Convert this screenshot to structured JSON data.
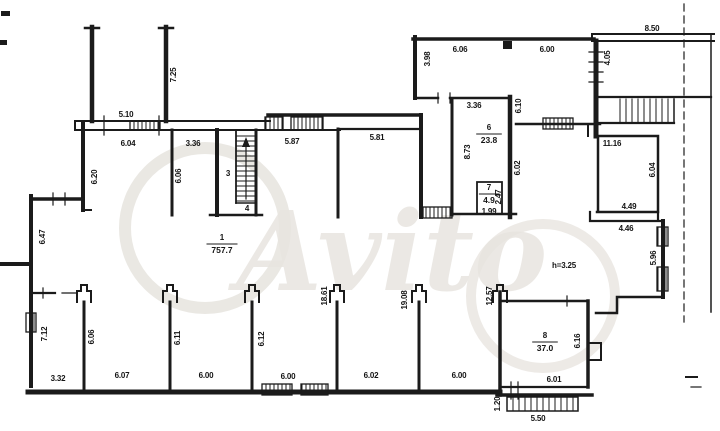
{
  "page": {
    "background": "#ffffff"
  },
  "watermark": {
    "text": "Avito",
    "color": "#e8e5e0"
  },
  "plan": {
    "ink": "#1b1b1b",
    "height_note": "h=3.25",
    "rooms": [
      {
        "num": "1",
        "area": "757.7",
        "x": 222,
        "y": 243
      },
      {
        "num": "6",
        "area": "23.8",
        "x": 489,
        "y": 133
      },
      {
        "num": "7",
        "area": "4.9",
        "x": 489,
        "y": 193
      },
      {
        "num": "8",
        "area": "37.0",
        "x": 545,
        "y": 341
      }
    ],
    "labels": [
      {
        "text": "5.10",
        "x": 126,
        "y": 117
      },
      {
        "text": "6.04",
        "x": 128,
        "y": 146
      },
      {
        "text": "3.36",
        "x": 193,
        "y": 146
      },
      {
        "text": "5.87",
        "x": 292,
        "y": 144
      },
      {
        "text": "5.81",
        "x": 377,
        "y": 140
      },
      {
        "text": "7.25",
        "x": 176,
        "y": 75,
        "rot": -90
      },
      {
        "text": "6.20",
        "x": 97,
        "y": 177,
        "rot": -90
      },
      {
        "text": "6.06",
        "x": 181,
        "y": 176,
        "rot": -90
      },
      {
        "text": "3",
        "x": 228,
        "y": 176
      },
      {
        "text": "4",
        "x": 247,
        "y": 211
      },
      {
        "text": "6.47",
        "x": 45,
        "y": 237,
        "rot": -90
      },
      {
        "text": "6.06",
        "x": 460,
        "y": 52
      },
      {
        "text": "6.00",
        "x": 547,
        "y": 52
      },
      {
        "text": "8.50",
        "x": 652,
        "y": 31
      },
      {
        "text": "3.98",
        "x": 430,
        "y": 59,
        "rot": -90
      },
      {
        "text": "4.05",
        "x": 610,
        "y": 58,
        "rot": -90
      },
      {
        "text": "3.36",
        "x": 474,
        "y": 108
      },
      {
        "text": "6.10",
        "x": 521,
        "y": 106,
        "rot": -90
      },
      {
        "text": "8.73",
        "x": 470,
        "y": 152,
        "rot": -90
      },
      {
        "text": "6.02",
        "x": 520,
        "y": 168,
        "rot": -90
      },
      {
        "text": "2.47",
        "x": 501,
        "y": 197,
        "rot": -90
      },
      {
        "text": "1.99",
        "x": 489,
        "y": 214
      },
      {
        "text": "11.16",
        "x": 612,
        "y": 146
      },
      {
        "text": "6.04",
        "x": 655,
        "y": 170,
        "rot": -90
      },
      {
        "text": "4.49",
        "x": 629,
        "y": 209
      },
      {
        "text": "4.46",
        "x": 626,
        "y": 231
      },
      {
        "text": "5.96",
        "x": 656,
        "y": 258,
        "rot": -90
      },
      {
        "text": "h=3.25",
        "x": 564,
        "y": 268
      },
      {
        "text": "12.57",
        "x": 492,
        "y": 296,
        "rot": -90
      },
      {
        "text": "6.16",
        "x": 580,
        "y": 341,
        "rot": -90
      },
      {
        "text": "6.01",
        "x": 554,
        "y": 382
      },
      {
        "text": "1.20",
        "x": 500,
        "y": 404,
        "rot": -90
      },
      {
        "text": "5.50",
        "x": 538,
        "y": 421
      },
      {
        "text": "7.12",
        "x": 47,
        "y": 334,
        "rot": -90
      },
      {
        "text": "3.32",
        "x": 58,
        "y": 381
      },
      {
        "text": "6.06",
        "x": 94,
        "y": 337,
        "rot": -90
      },
      {
        "text": "6.07",
        "x": 122,
        "y": 378
      },
      {
        "text": "6.11",
        "x": 180,
        "y": 338,
        "rot": -90
      },
      {
        "text": "6.00",
        "x": 206,
        "y": 378
      },
      {
        "text": "6.12",
        "x": 264,
        "y": 339,
        "rot": -90
      },
      {
        "text": "6.00",
        "x": 288,
        "y": 379
      },
      {
        "text": "18.61",
        "x": 327,
        "y": 296,
        "rot": -90
      },
      {
        "text": "6.02",
        "x": 371,
        "y": 378
      },
      {
        "text": "19.08",
        "x": 407,
        "y": 300,
        "rot": -90
      },
      {
        "text": "6.00",
        "x": 459,
        "y": 378
      }
    ]
  }
}
